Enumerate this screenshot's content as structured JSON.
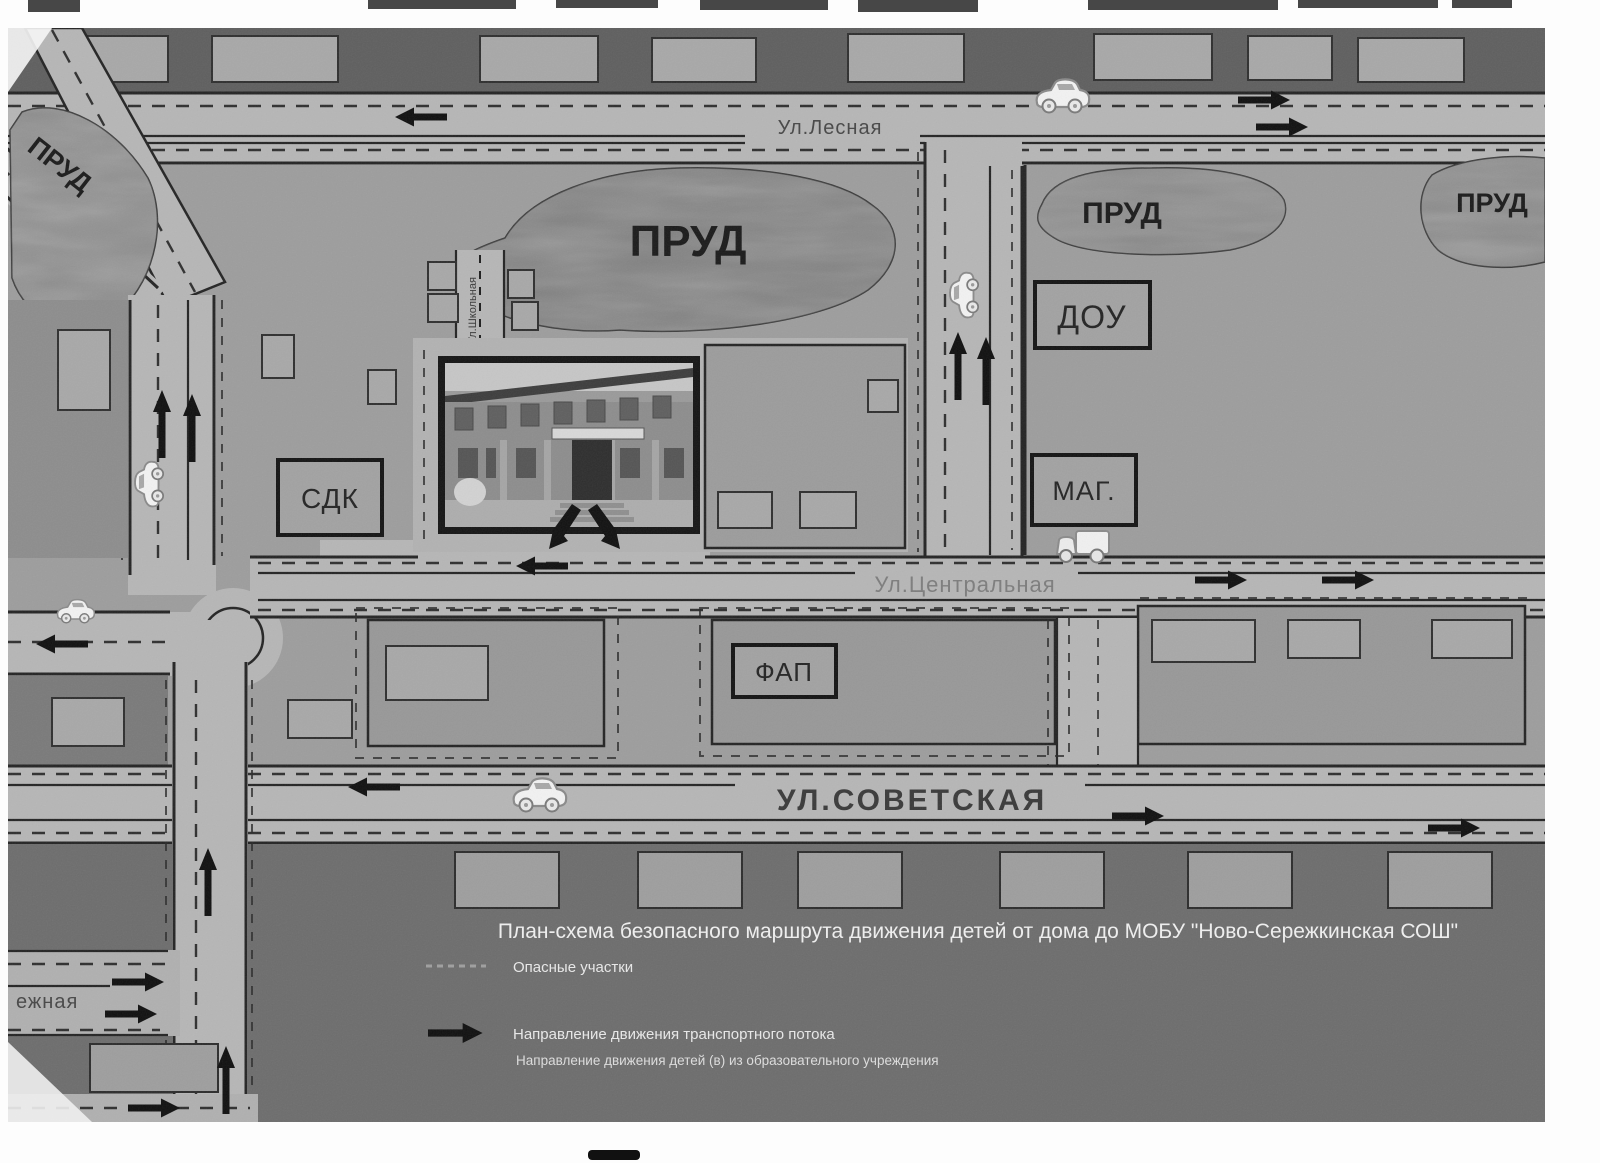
{
  "map": {
    "streets": {
      "lesnaya": "Ул.Лесная",
      "shkolnaya": "Ул.Школьная",
      "tsentralnaya": "Ул.Центральная",
      "sovetskaya": "УЛ.СОВЕТСКАЯ",
      "naberezhnaya_fragment": "ежная"
    },
    "pond_label": "ПРУД",
    "buildings": {
      "sdk": "СДК",
      "dou": "ДОУ",
      "mag": "МАГ.",
      "fap": "ФАП"
    },
    "icons": {
      "car": "car-icon",
      "truck": "truck-icon",
      "traffic_arrow": "traffic-flow-arrow-icon",
      "roundabout": "roundabout-icon"
    },
    "colors": {
      "paper": "#ffffff",
      "road": "#b6b6b6",
      "block": "#9d9d9d",
      "block_dark": "#6d6d6d",
      "pond": "#858585",
      "ink": "#1a1a1a",
      "light_text": "#efefef"
    }
  },
  "legend": {
    "title": "План-схема безопасного маршрута движения детей от дома до МОБУ \"Ново-Сережкинская СОШ\"",
    "items": [
      {
        "label": "Опасные участки"
      },
      {
        "label": "Направление движения транспортного потока"
      },
      {
        "label": "Направление движения детей (в) из образовательного учреждения"
      }
    ]
  }
}
